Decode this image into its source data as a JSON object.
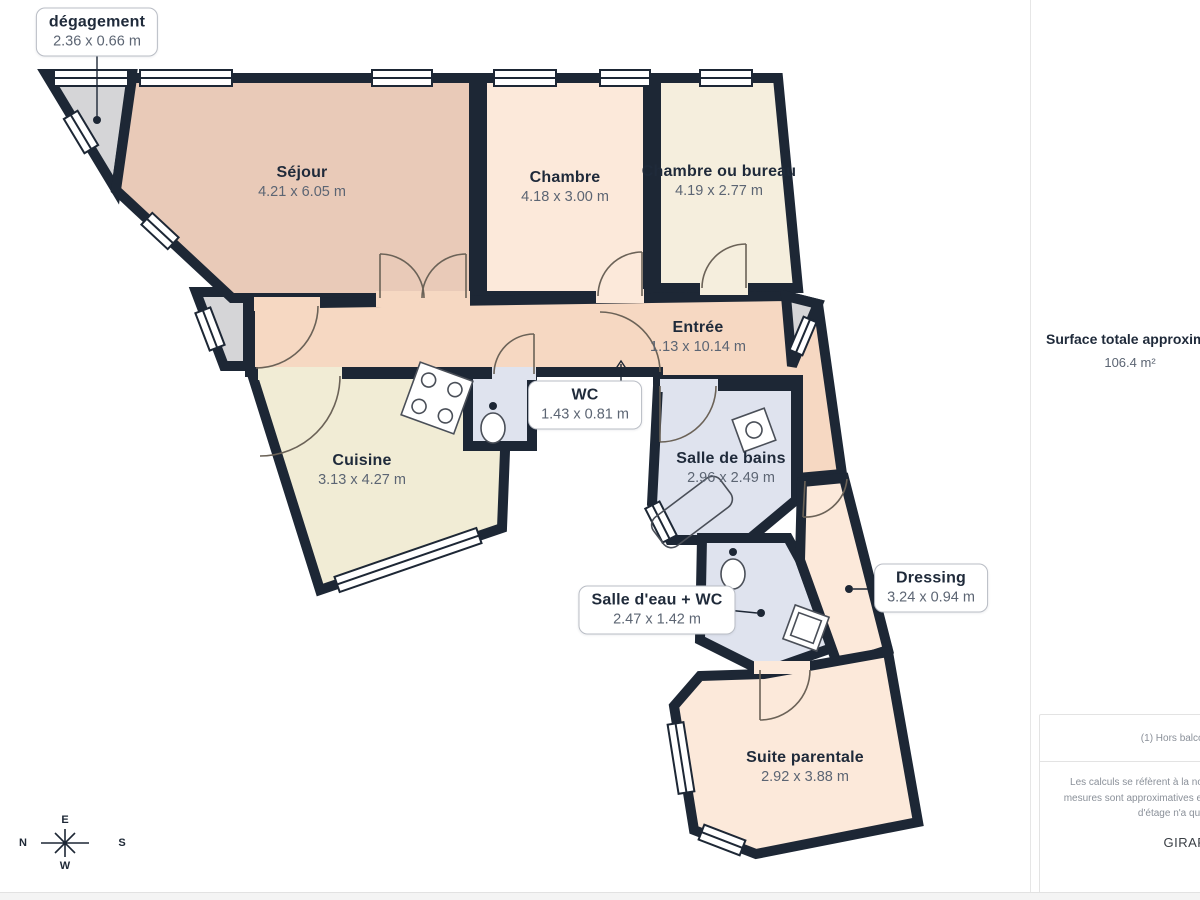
{
  "plan": {
    "rooms": [
      {
        "id": "degagement",
        "name": "dégagement",
        "dims": "2.36 x 0.66 m",
        "boxed": true
      },
      {
        "id": "sejour",
        "name": "Séjour",
        "dims": "4.21 x 6.05 m",
        "boxed": false
      },
      {
        "id": "chambre",
        "name": "Chambre",
        "dims": "4.18 x 3.00 m",
        "boxed": false
      },
      {
        "id": "chambre_bureau",
        "name": "Chambre ou bureau",
        "dims": "4.19 x 2.77 m",
        "boxed": false
      },
      {
        "id": "entree",
        "name": "Entrée",
        "dims": "1.13 x 10.14 m",
        "boxed": false
      },
      {
        "id": "wc",
        "name": "WC",
        "dims": "1.43 x 0.81 m",
        "boxed": true
      },
      {
        "id": "cuisine",
        "name": "Cuisine",
        "dims": "3.13 x 4.27 m",
        "boxed": false
      },
      {
        "id": "salle_de_bains",
        "name": "Salle de bains",
        "dims": "2.96 x 2.49 m",
        "boxed": false
      },
      {
        "id": "salle_eau_wc",
        "name": "Salle d'eau + WC",
        "dims": "2.47 x 1.42 m",
        "boxed": true
      },
      {
        "id": "dressing",
        "name": "Dressing",
        "dims": "3.24 x 0.94 m",
        "boxed": true
      },
      {
        "id": "suite_parentale",
        "name": "Suite parentale",
        "dims": "2.92 x 3.88 m",
        "boxed": false
      }
    ],
    "compass": {
      "top": "E",
      "left": "N",
      "right": "S",
      "bottom": "W"
    }
  },
  "sidebar": {
    "surface_title": "Surface totale approximative",
    "surface_value": "106.4 m²",
    "footnote": "(1) Hors balcons et terrasses",
    "disclaimer": "Les calculs se réfèrent à la norme RICS IPMS 3C. Toutes les mesures sont approximatives et ne sont pas à l'échelle. Ce plan d'étage n'a qu'un but illustratif.",
    "brand_name": "GIRAFFE",
    "brand_suffix": "360"
  },
  "colors": {
    "wall": "#1d2735",
    "sejour": "#e9cab8",
    "chambre": "#fce9da",
    "chambre_bureau": "#f5eedd",
    "entree": "#f6d8c2",
    "cuisine": "#f1ecd5",
    "wet": "#dfe3ee",
    "suite": "#fce9da",
    "gray": "#d5d5d7"
  }
}
